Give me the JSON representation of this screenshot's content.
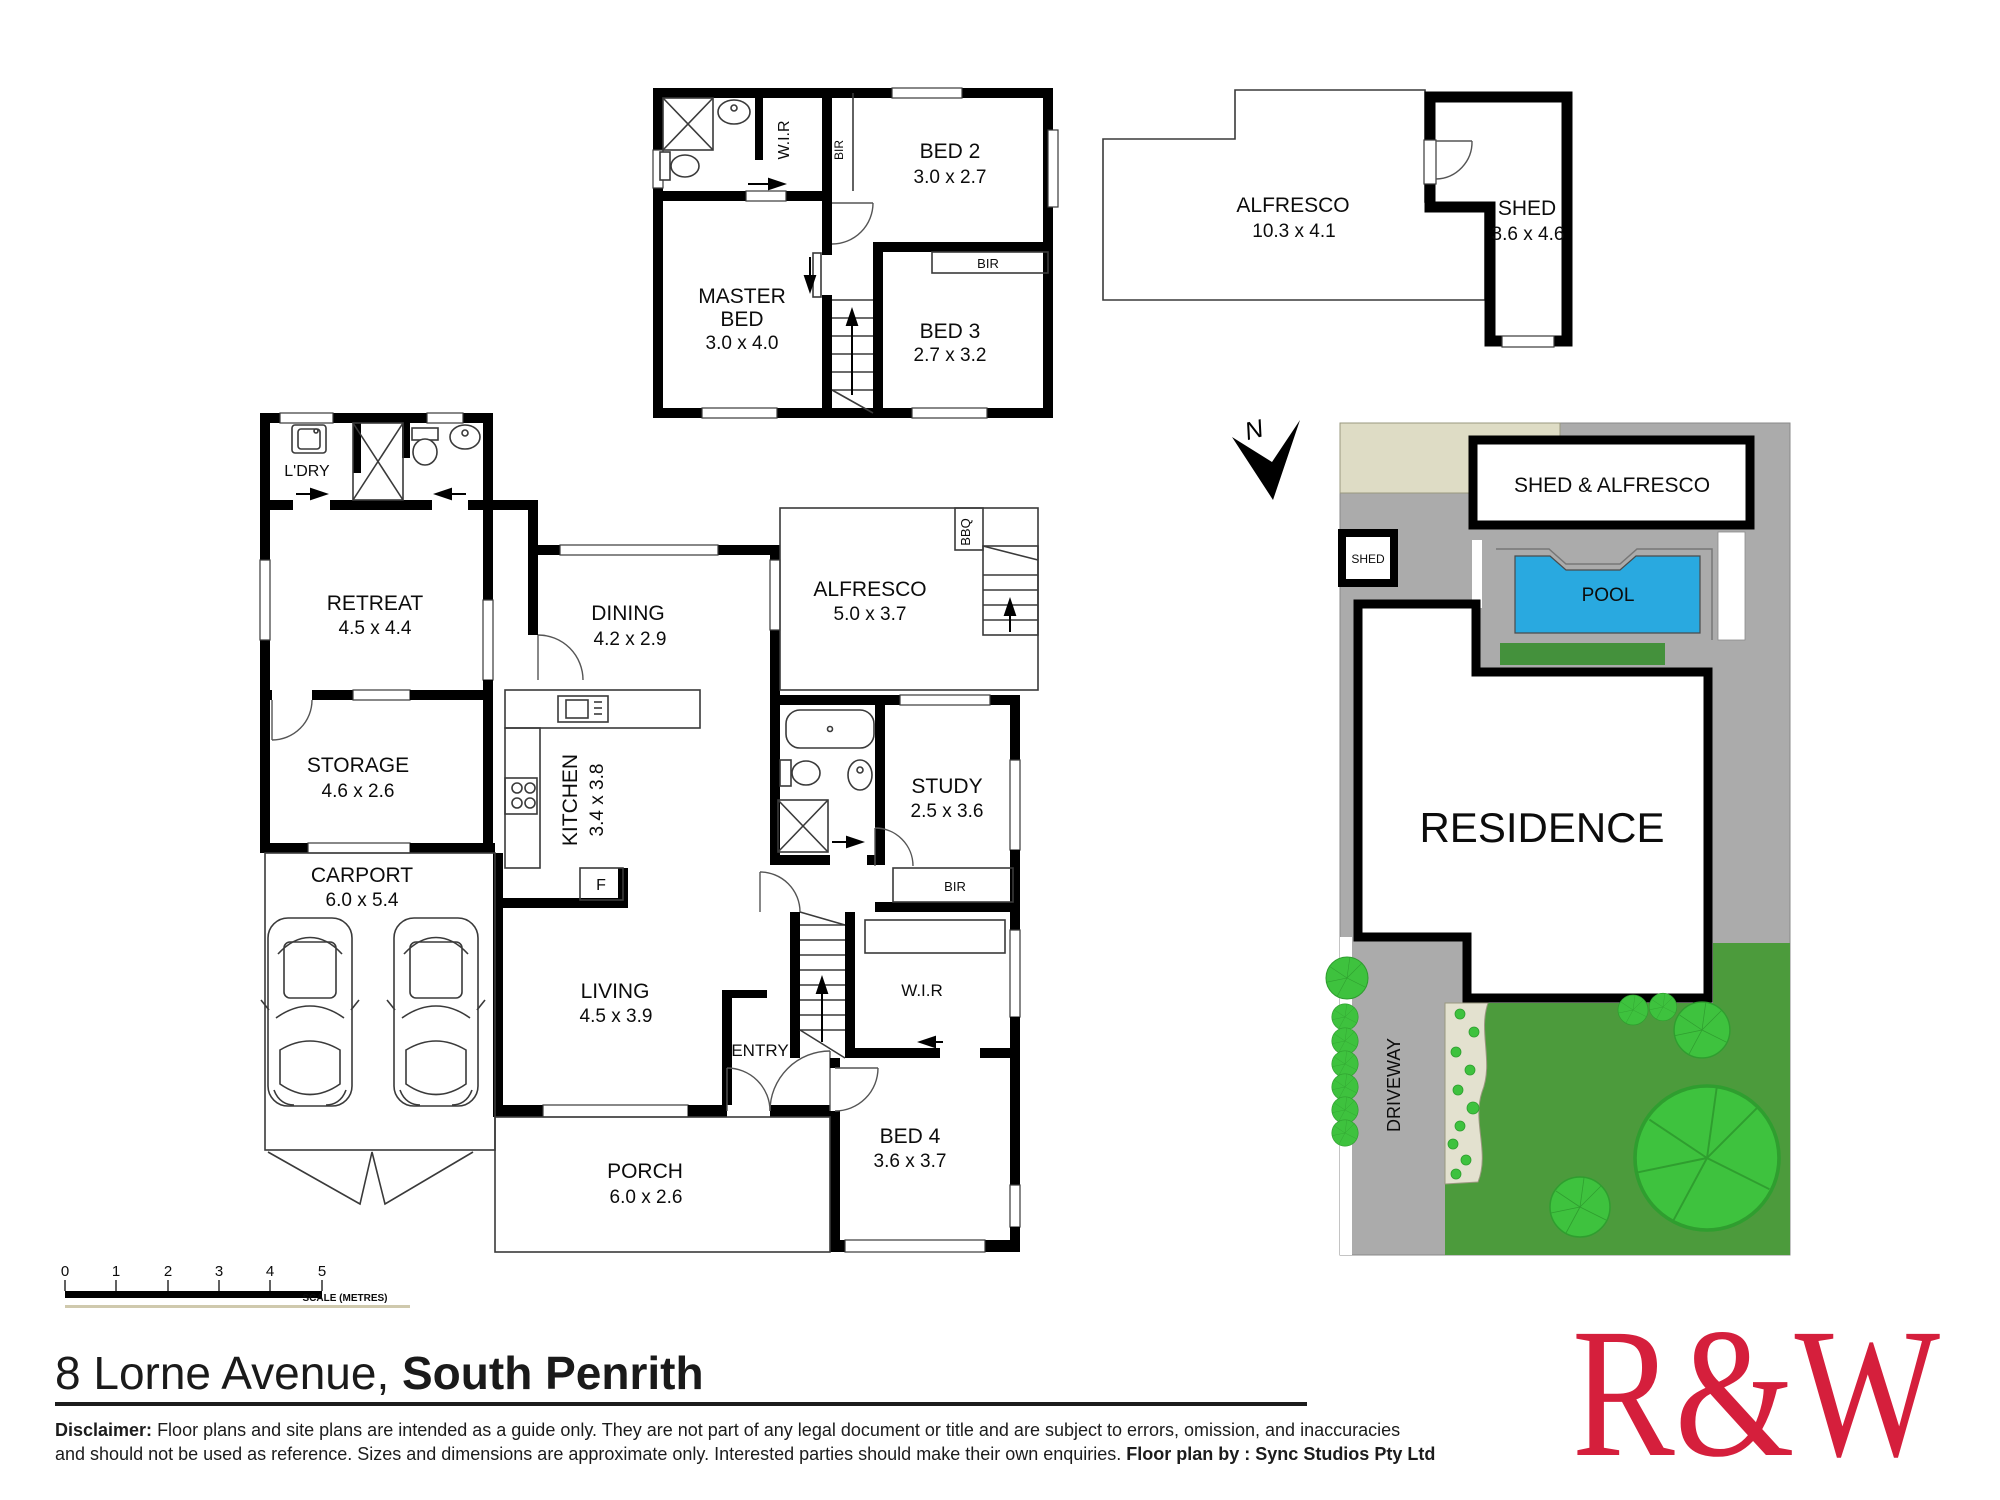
{
  "floor_plan": {
    "upper": {
      "wir": "W.I.R",
      "bir_side": "BIR",
      "bir_closet": "BIR",
      "bed2": {
        "name": "BED 2",
        "dims": "3.0 x 2.7"
      },
      "master": {
        "l1": "MASTER",
        "l2": "BED",
        "dims": "3.0 x 4.0"
      },
      "bed3": {
        "name": "BED 3",
        "dims": "2.7 x 3.2"
      }
    },
    "outbuilding": {
      "alfresco": {
        "name": "ALFRESCO",
        "dims": "10.3 x 4.1"
      },
      "shed": {
        "name": "SHED",
        "dims": "3.6 x 4.6"
      }
    },
    "ground": {
      "ldry": "L'DRY",
      "retreat": {
        "name": "RETREAT",
        "dims": "4.5 x 4.4"
      },
      "storage": {
        "name": "STORAGE",
        "dims": "4.6 x 2.6"
      },
      "carport": {
        "name": "CARPORT",
        "dims": "6.0 x 5.4"
      },
      "dining": {
        "name": "DINING",
        "dims": "4.2 x 2.9"
      },
      "kitchen": {
        "name": "KITCHEN",
        "dims": "3.4 x 3.8"
      },
      "fridge": "F",
      "alfresco": {
        "name": "ALFRESCO",
        "dims": "5.0 x 3.7"
      },
      "bbq": "BBQ",
      "study": {
        "name": "STUDY",
        "dims": "2.5 x 3.6"
      },
      "bir": "BIR",
      "wir": "W.I.R",
      "entry": "ENTRY",
      "living": {
        "name": "LIVING",
        "dims": "4.5 x 3.9"
      },
      "bed4": {
        "name": "BED 4",
        "dims": "3.6 x 3.7"
      },
      "porch": {
        "name": "PORCH",
        "dims": "6.0 x 2.6"
      }
    }
  },
  "site_plan": {
    "north": "N",
    "shed_alfresco": "SHED & ALFRESCO",
    "shed": "SHED",
    "pool": "POOL",
    "residence": "RESIDENCE",
    "driveway": "DRIVEWAY"
  },
  "scale_bar": {
    "labels": [
      "0",
      "1",
      "2",
      "3",
      "4",
      "5"
    ],
    "caption": "SCALE (METRES)"
  },
  "footer": {
    "address_street": "8 Lorne Avenue, ",
    "address_suburb": "South Penrith",
    "disclaimer_label": "Disclaimer:",
    "disclaimer_line1": " Floor plans and site plans are intended as a guide only. They are not part of any legal document or title and are subject to errors, omission, and inaccuracies",
    "disclaimer_line2": "and should not be used as reference. Sizes and dimensions are approximate only. Interested parties should make their own enquiries. ",
    "credit": "Floor plan by : Sync Studios Pty Ltd",
    "logo": "R&W"
  },
  "colors": {
    "logo_red": "#d51f3c",
    "pool_blue": "#29a9e0",
    "lawn_green": "#4c9b3c",
    "tree_green": "#3ec23e",
    "paving_gray": "#ababab",
    "beige": "#dedcc5",
    "garden_bed": "#e3e1cf",
    "pool_strip_green": "#44913c"
  }
}
